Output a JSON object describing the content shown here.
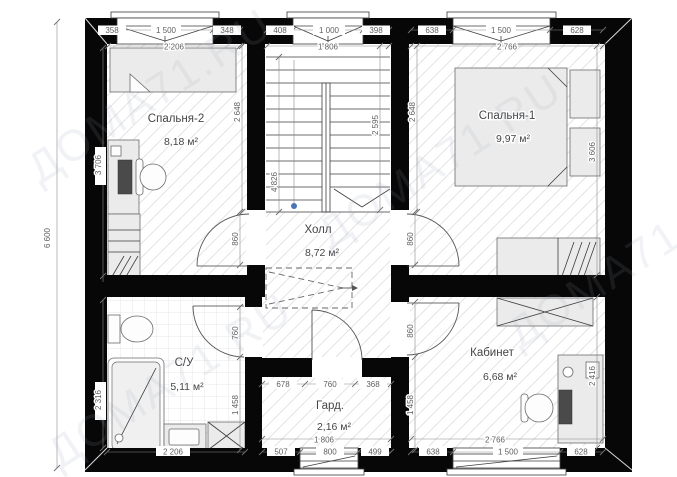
{
  "watermark": {
    "text": "ДОМА71.RU"
  },
  "rooms": {
    "bedroom2": {
      "name": "Спальня-2",
      "area": "8,18 м²"
    },
    "bedroom1": {
      "name": "Спальня-1",
      "area": "9,97 м²"
    },
    "hall": {
      "name": "Холл",
      "area": "8,72 м²"
    },
    "bathroom": {
      "name": "С/У",
      "area": "5,11 м²"
    },
    "wardrobe": {
      "name": "Гард.",
      "area": "2,16 м²"
    },
    "office": {
      "name": "Кабинет",
      "area": "6,68 м²"
    }
  },
  "dims": {
    "overall_left": "6 600",
    "top_bedroom2": {
      "parts": [
        "358",
        "1 500",
        "348"
      ],
      "total": "2 206"
    },
    "top_stairs": {
      "parts": [
        "408",
        "1 000",
        "398"
      ],
      "total": "1 806"
    },
    "top_bedroom1": {
      "parts": [
        "638",
        "1 500",
        "628"
      ],
      "total": "2 766"
    },
    "bedroom2_left": "3 706",
    "bedroom2_right": "2 648",
    "bathroom_left": "2 316",
    "stairs_left": "4 826",
    "stairs_right": "2 595",
    "bedroom1_left": "2 648",
    "bedroom1_right": "3 606",
    "office_right": "2 416",
    "door_bedroom2": "860",
    "door_bedroom1": "860",
    "door_bathroom": "760",
    "door_office": "860",
    "lower_wall_left": "1 458",
    "lower_wall_right": "1 458",
    "wardrobe_top": {
      "parts": [
        "678",
        "760",
        "368"
      ]
    },
    "bathroom_bottom": "2 206",
    "bottom_wardrobe": {
      "parts": [
        "507",
        "800",
        "499"
      ],
      "total": "1 806"
    },
    "bottom_office": {
      "parts": [
        "638",
        "1 500",
        "628"
      ],
      "total": "2 766"
    }
  }
}
